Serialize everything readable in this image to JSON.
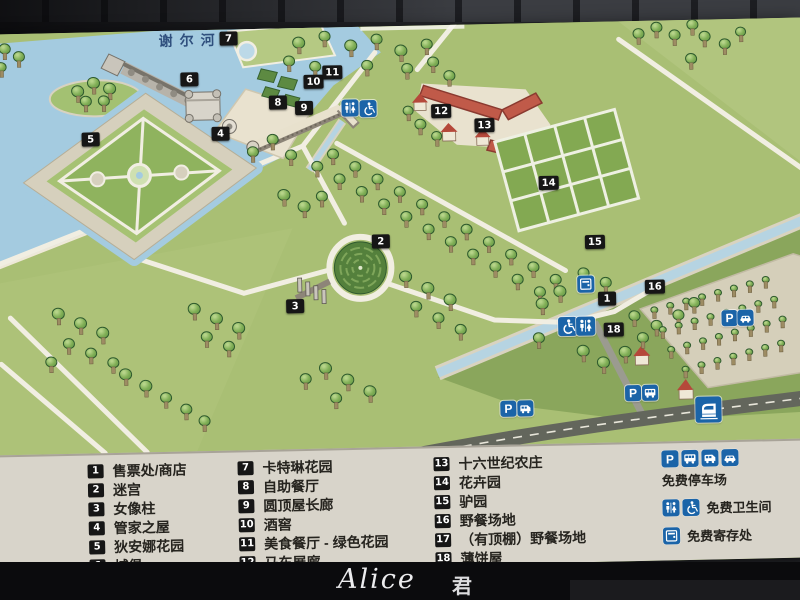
{
  "map": {
    "river_label": "谢尔河",
    "markers": [
      {
        "n": "1",
        "x": 613,
        "y": 277
      },
      {
        "n": "2",
        "x": 388,
        "y": 215
      },
      {
        "n": "3",
        "x": 301,
        "y": 278
      },
      {
        "n": "4",
        "x": 230,
        "y": 104
      },
      {
        "n": "5",
        "x": 100,
        "y": 107
      },
      {
        "n": "6",
        "x": 200,
        "y": 49
      },
      {
        "n": "7",
        "x": 240,
        "y": 9
      },
      {
        "n": "8",
        "x": 288,
        "y": 74
      },
      {
        "n": "9",
        "x": 314,
        "y": 80
      },
      {
        "n": "10",
        "x": 324,
        "y": 54
      },
      {
        "n": "11",
        "x": 343,
        "y": 45
      },
      {
        "n": "12",
        "x": 451,
        "y": 86
      },
      {
        "n": "13",
        "x": 494,
        "y": 101
      },
      {
        "n": "14",
        "x": 557,
        "y": 160
      },
      {
        "n": "15",
        "x": 602,
        "y": 220
      },
      {
        "n": "16",
        "x": 661,
        "y": 266
      },
      {
        "n": "18",
        "x": 619,
        "y": 308
      }
    ],
    "icons": [
      {
        "t": "toilet",
        "x": 360,
        "y": 81,
        "s": 17
      },
      {
        "t": "wheelchair",
        "x": 378,
        "y": 82,
        "s": 17
      },
      {
        "t": "locker",
        "x": 592,
        "y": 262,
        "s": 17
      },
      {
        "t": "wheelchair",
        "x": 573,
        "y": 304,
        "s": 19
      },
      {
        "t": "toilet",
        "x": 591,
        "y": 304,
        "s": 19
      },
      {
        "t": "parking",
        "x": 735,
        "y": 299,
        "s": 16
      },
      {
        "t": "car",
        "x": 751,
        "y": 299,
        "s": 16
      },
      {
        "t": "parking",
        "x": 637,
        "y": 372,
        "s": 16
      },
      {
        "t": "bus",
        "x": 654,
        "y": 372,
        "s": 16
      },
      {
        "t": "parking",
        "x": 512,
        "y": 385,
        "s": 16
      },
      {
        "t": "rv",
        "x": 529,
        "y": 385,
        "s": 16
      },
      {
        "t": "train",
        "x": 712,
        "y": 390,
        "s": 26
      }
    ],
    "trees": [
      [
        88,
        60,
        13
      ],
      [
        104,
        52,
        13
      ],
      [
        120,
        58,
        13
      ],
      [
        96,
        70,
        12
      ],
      [
        114,
        70,
        12
      ],
      [
        16,
        16,
        12
      ],
      [
        30,
        24,
        12
      ],
      [
        12,
        34,
        11
      ],
      [
        310,
        16,
        13
      ],
      [
        336,
        10,
        12
      ],
      [
        362,
        20,
        13
      ],
      [
        388,
        14,
        12
      ],
      [
        412,
        26,
        13
      ],
      [
        438,
        20,
        12
      ],
      [
        300,
        34,
        12
      ],
      [
        326,
        40,
        12
      ],
      [
        418,
        44,
        12
      ],
      [
        444,
        38,
        12
      ],
      [
        460,
        52,
        12
      ],
      [
        378,
        40,
        12
      ],
      [
        282,
        112,
        12
      ],
      [
        262,
        124,
        12
      ],
      [
        300,
        128,
        12
      ],
      [
        292,
        168,
        13
      ],
      [
        312,
        180,
        13
      ],
      [
        330,
        170,
        12
      ],
      [
        650,
        14,
        12
      ],
      [
        668,
        8,
        12
      ],
      [
        686,
        16,
        12
      ],
      [
        704,
        6,
        12
      ],
      [
        716,
        18,
        12
      ],
      [
        736,
        26,
        12
      ],
      [
        702,
        40,
        12
      ],
      [
        752,
        14,
        11
      ],
      [
        342,
        128,
        12
      ],
      [
        364,
        141,
        12
      ],
      [
        386,
        154,
        12
      ],
      [
        408,
        167,
        12
      ],
      [
        430,
        180,
        12
      ],
      [
        452,
        193,
        12
      ],
      [
        474,
        206,
        12
      ],
      [
        496,
        219,
        12
      ],
      [
        518,
        232,
        12
      ],
      [
        540,
        245,
        12
      ],
      [
        562,
        258,
        12
      ],
      [
        326,
        140,
        12
      ],
      [
        348,
        153,
        12
      ],
      [
        370,
        166,
        12
      ],
      [
        392,
        179,
        12
      ],
      [
        414,
        192,
        12
      ],
      [
        436,
        205,
        12
      ],
      [
        458,
        218,
        12
      ],
      [
        480,
        231,
        12
      ],
      [
        502,
        244,
        12
      ],
      [
        524,
        257,
        12
      ],
      [
        546,
        270,
        12
      ],
      [
        430,
        100,
        12
      ],
      [
        446,
        112,
        11
      ],
      [
        418,
        86,
        11
      ],
      [
        412,
        252,
        13
      ],
      [
        434,
        264,
        13
      ],
      [
        456,
        276,
        13
      ],
      [
        422,
        282,
        12
      ],
      [
        444,
        294,
        12
      ],
      [
        466,
        306,
        12
      ],
      [
        64,
        282,
        13
      ],
      [
        86,
        292,
        13
      ],
      [
        108,
        302,
        13
      ],
      [
        74,
        312,
        12
      ],
      [
        96,
        322,
        12
      ],
      [
        118,
        332,
        12
      ],
      [
        56,
        330,
        12
      ],
      [
        130,
        344,
        13
      ],
      [
        150,
        356,
        13
      ],
      [
        170,
        368,
        12
      ],
      [
        190,
        380,
        12
      ],
      [
        208,
        392,
        12
      ],
      [
        200,
        280,
        13
      ],
      [
        222,
        290,
        13
      ],
      [
        244,
        300,
        13
      ],
      [
        212,
        308,
        12
      ],
      [
        234,
        318,
        12
      ],
      [
        330,
        342,
        13
      ],
      [
        352,
        354,
        13
      ],
      [
        374,
        366,
        13
      ],
      [
        340,
        372,
        12
      ],
      [
        310,
        352,
        12
      ],
      [
        548,
        282,
        13
      ],
      [
        566,
        270,
        13
      ],
      [
        588,
        330,
        13
      ],
      [
        608,
        342,
        13
      ],
      [
        630,
        332,
        13
      ],
      [
        648,
        318,
        12
      ],
      [
        544,
        316,
        12
      ],
      [
        640,
        296,
        12
      ],
      [
        662,
        306,
        12
      ],
      [
        684,
        296,
        12
      ],
      [
        700,
        284,
        12
      ],
      [
        590,
        252,
        12
      ],
      [
        612,
        262,
        12
      ],
      [
        660,
        290,
        8
      ],
      [
        676,
        286,
        8
      ],
      [
        692,
        282,
        8
      ],
      [
        708,
        278,
        8
      ],
      [
        724,
        274,
        8
      ],
      [
        740,
        270,
        8
      ],
      [
        756,
        266,
        8
      ],
      [
        772,
        262,
        8
      ],
      [
        668,
        310,
        8
      ],
      [
        684,
        306,
        8
      ],
      [
        700,
        302,
        8
      ],
      [
        716,
        298,
        8
      ],
      [
        732,
        294,
        8
      ],
      [
        748,
        290,
        8
      ],
      [
        764,
        286,
        8
      ],
      [
        780,
        282,
        8
      ],
      [
        676,
        330,
        8
      ],
      [
        692,
        326,
        8
      ],
      [
        708,
        322,
        8
      ],
      [
        724,
        318,
        8
      ],
      [
        740,
        314,
        8
      ],
      [
        756,
        310,
        8
      ],
      [
        772,
        306,
        8
      ],
      [
        788,
        302,
        8
      ],
      [
        690,
        350,
        8
      ],
      [
        706,
        346,
        8
      ],
      [
        722,
        342,
        8
      ],
      [
        738,
        338,
        8
      ],
      [
        754,
        334,
        8
      ],
      [
        770,
        330,
        8
      ],
      [
        786,
        326,
        8
      ]
    ]
  },
  "legend": {
    "columns": [
      [
        {
          "n": "1",
          "label": "售票处/商店"
        },
        {
          "n": "2",
          "label": "迷宫"
        },
        {
          "n": "3",
          "label": "女像柱"
        },
        {
          "n": "4",
          "label": "管家之屋"
        },
        {
          "n": "5",
          "label": "狄安娜花园"
        },
        {
          "n": "6",
          "label": "城堡"
        }
      ],
      [
        {
          "n": "7",
          "label": "卡特琳花园"
        },
        {
          "n": "8",
          "label": "自助餐厅"
        },
        {
          "n": "9",
          "label": "圆顶屋长廊"
        },
        {
          "n": "10",
          "label": "酒窖"
        },
        {
          "n": "11",
          "label": "美食餐厅 - 绿色花园"
        },
        {
          "n": "12",
          "label": "马车展廊"
        }
      ],
      [
        {
          "n": "13",
          "label": "十六世纪农庄"
        },
        {
          "n": "14",
          "label": "花卉园"
        },
        {
          "n": "15",
          "label": "驴园"
        },
        {
          "n": "16",
          "label": "野餐场地"
        },
        {
          "n": "17",
          "label": "（有顶棚）野餐场地"
        },
        {
          "n": "18",
          "label": "薄饼屋"
        }
      ]
    ],
    "facilities": [
      {
        "icons": [
          "parking",
          "bus",
          "rv",
          "car"
        ],
        "label": "免费停车场",
        "layout": "stacked"
      },
      {
        "icons": [
          "toilet",
          "wheelchair"
        ],
        "label": "免费卫生间",
        "layout": "inline"
      },
      {
        "icons": [
          "locker"
        ],
        "label": "免费寄存处",
        "layout": "inline"
      }
    ]
  },
  "watermark": {
    "script": "Alice",
    "cjk": "君"
  },
  "colors": {
    "icon_blue": "#1b64a8",
    "marker_black": "#161616",
    "map_green": "#a9bf74",
    "water": "#a4cbe0",
    "legend_bg": "#d8d4ca",
    "roof_red": "#c05a49"
  }
}
